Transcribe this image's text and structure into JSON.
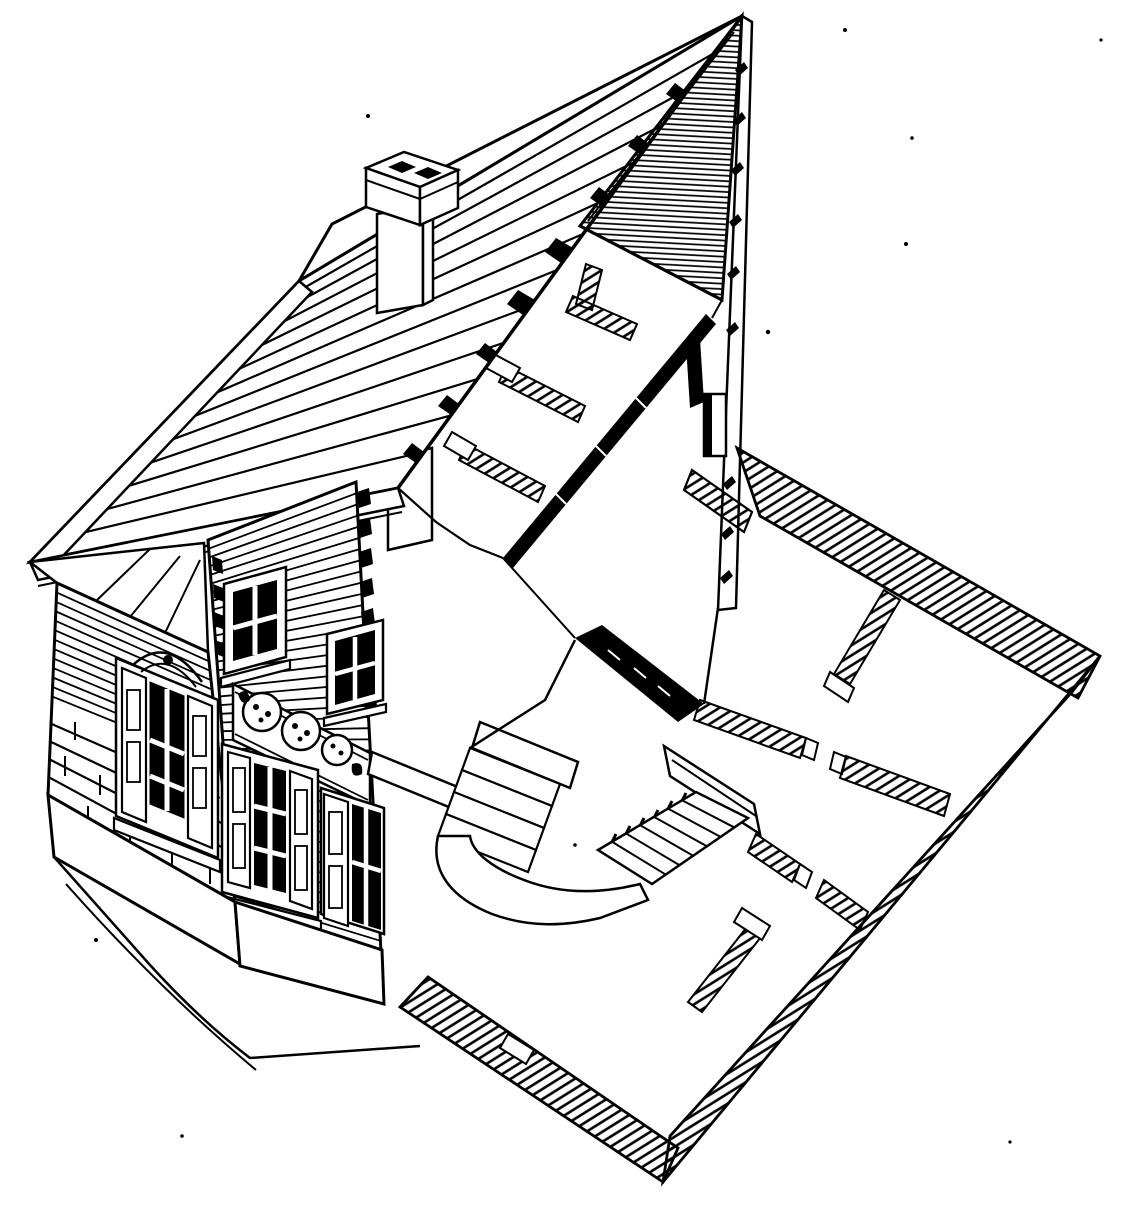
{
  "figure": {
    "kind": "architectural cutaway line drawing",
    "view": "axonometric / perspective cutaway",
    "subject": "Axonometric cutaway ink drawing of a two-story gabled house, sliced diagonally to expose the hatched ground-floor plan, attic floor, interior stair and entry steps; intact half shows shingled roof, chimney, clapboard facade with shuttered windows, rosette frieze band and brick gable wall",
    "colors": {
      "ink": "#000000",
      "paper": "#ffffff"
    },
    "components": [
      "roof-slope",
      "roof-back-sliver",
      "barge-board",
      "eave-fascia",
      "chimney",
      "gable-cross-section",
      "cut-wall-edge",
      "attic-floor",
      "attic-partitions",
      "attic-floor-shadow-edge",
      "left-gable-wall",
      "brick-courses",
      "gable-soffit",
      "left-wall-window",
      "front-facade",
      "clapboard",
      "upper-windows",
      "rosette-frieze",
      "lower-windows",
      "plinth",
      "ground-lines",
      "entry-steps",
      "entry-parapet",
      "walkway",
      "entry-apron",
      "interior-stair",
      "stair-side-slab",
      "stairwell-shadow-wall",
      "floor-plan-outer-walls",
      "floor-plan-partitions",
      "door-jambs",
      "ink-specks"
    ]
  }
}
